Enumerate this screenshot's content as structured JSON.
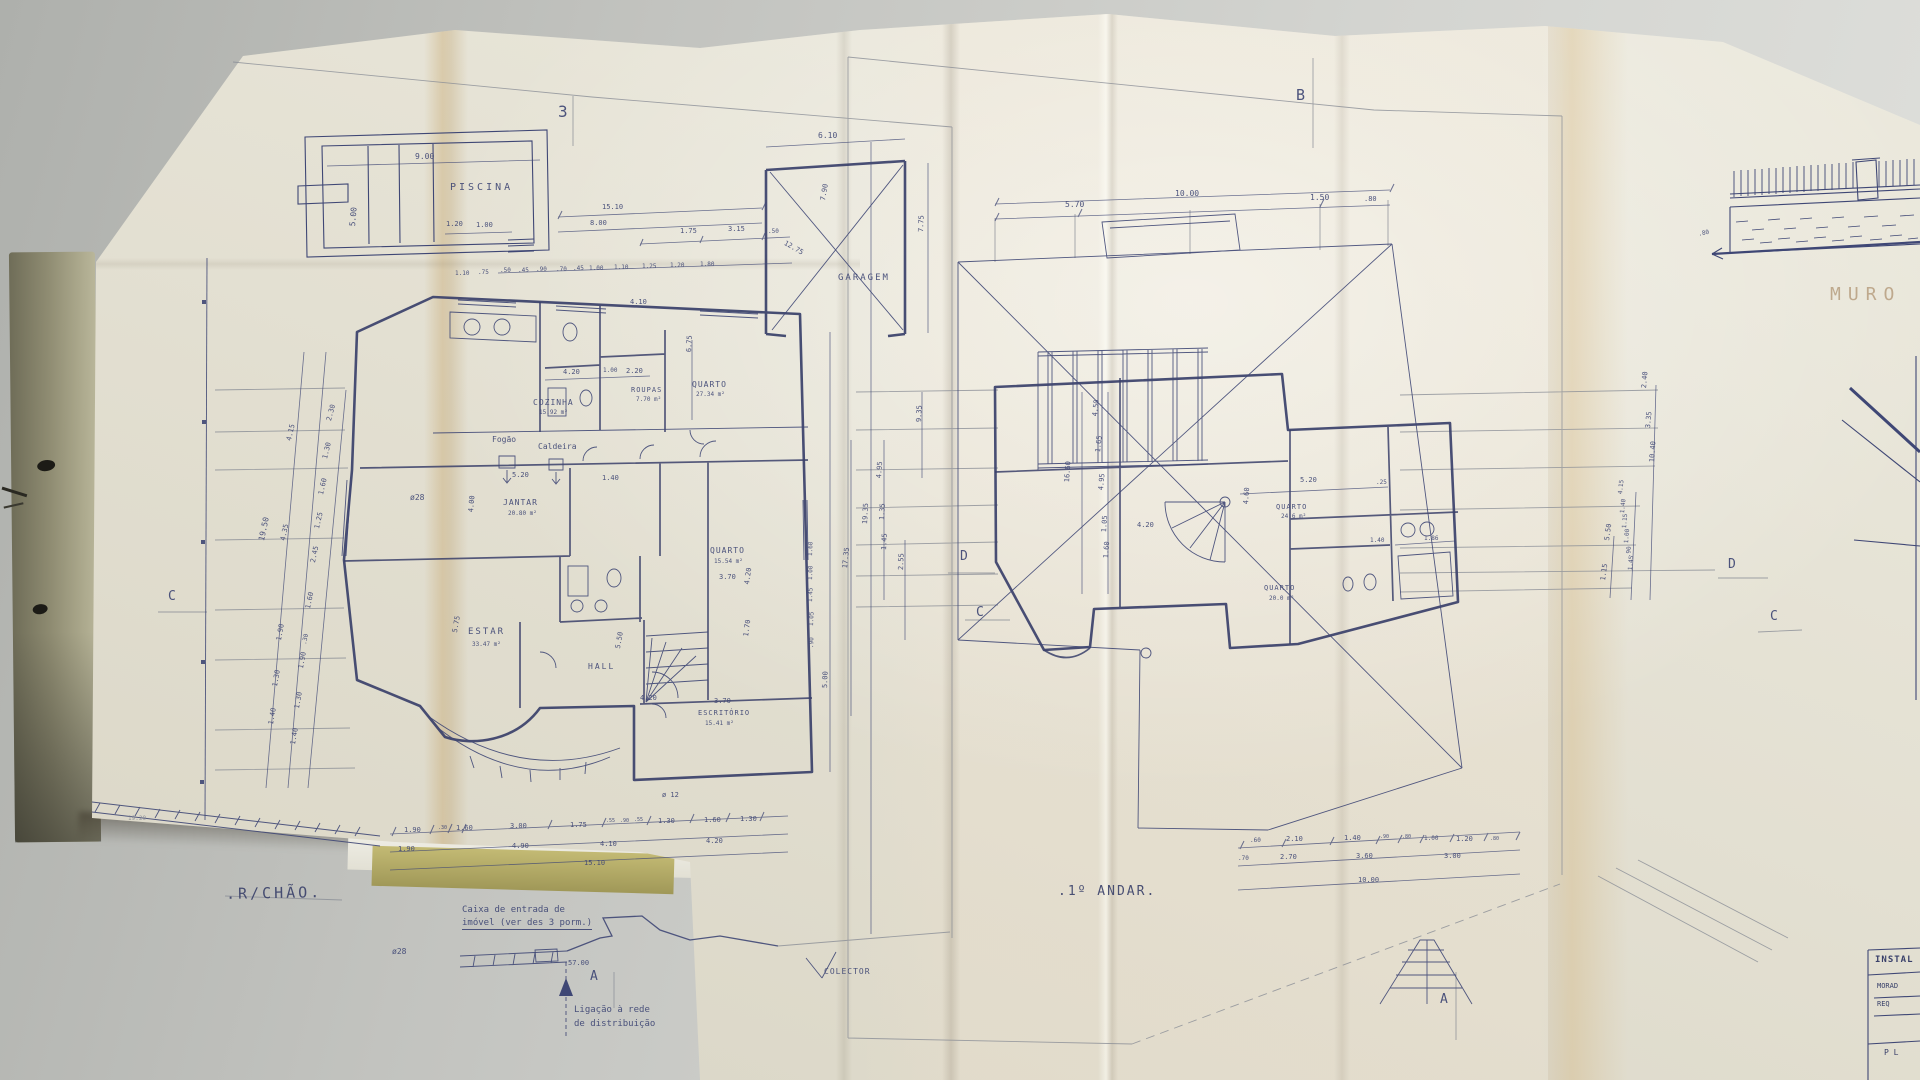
{
  "colors": {
    "ink": "#3f4775",
    "ink-dark": "#39406a",
    "pencil": "#8a8d96",
    "faded": "#b49a7a",
    "paper": "#e9e6d8",
    "fold": "#d6b684",
    "desk": "#c6c7c3"
  },
  "sheets": [
    {
      "title": ".R/CHÃO."
    },
    {
      "title": ".1º ANDAR."
    }
  ],
  "titleblock": {
    "header": "INSTAL",
    "row1": "MORAD",
    "row2": "REQ",
    "row3": "P L"
  },
  "annotations": [
    {
      "t": "PISCINA",
      "n": "label-piscina",
      "x": 450,
      "y": 183,
      "s": 10,
      "ls": 3
    },
    {
      "t": "9.00",
      "x": 415,
      "y": 153,
      "s": 8
    },
    {
      "t": "5.00",
      "x": 349,
      "y": 226,
      "s": 8,
      "r": -85
    },
    {
      "t": "1.20",
      "x": 446,
      "y": 221,
      "s": 7
    },
    {
      "t": "1.00",
      "x": 476,
      "y": 222,
      "s": 7
    },
    {
      "t": "3",
      "n": "marker-3",
      "x": 558,
      "y": 104,
      "s": 16
    },
    {
      "t": "15.10",
      "x": 602,
      "y": 204,
      "s": 7
    },
    {
      "t": "8.00",
      "x": 590,
      "y": 220,
      "s": 7
    },
    {
      "t": "1.75",
      "x": 680,
      "y": 228,
      "s": 7
    },
    {
      "t": "3.15",
      "x": 728,
      "y": 226,
      "s": 7
    },
    {
      "t": ".50",
      "x": 768,
      "y": 229,
      "s": 6
    },
    {
      "t": "1.10",
      "x": 455,
      "y": 271,
      "s": 6
    },
    {
      "t": ".75",
      "x": 478,
      "y": 270,
      "s": 6
    },
    {
      "t": ".50",
      "x": 500,
      "y": 268,
      "s": 6
    },
    {
      "t": ".45",
      "x": 518,
      "y": 268,
      "s": 6
    },
    {
      "t": ".90",
      "x": 536,
      "y": 267,
      "s": 6
    },
    {
      "t": ".70",
      "x": 556,
      "y": 267,
      "s": 6
    },
    {
      "t": ".45",
      "x": 573,
      "y": 266,
      "s": 6
    },
    {
      "t": "1.00",
      "x": 589,
      "y": 266,
      "s": 6
    },
    {
      "t": "1.10",
      "x": 614,
      "y": 265,
      "s": 6
    },
    {
      "t": "1.25",
      "x": 642,
      "y": 264,
      "s": 6
    },
    {
      "t": "1.20",
      "x": 670,
      "y": 263,
      "s": 6
    },
    {
      "t": "1.80",
      "x": 700,
      "y": 262,
      "s": 6
    },
    {
      "t": "6.10",
      "x": 818,
      "y": 132,
      "s": 8
    },
    {
      "t": "GARAGEM",
      "n": "label-garagem",
      "x": 838,
      "y": 274,
      "s": 9,
      "ls": 2
    },
    {
      "t": "7.75",
      "x": 918,
      "y": 232,
      "s": 7,
      "r": -88
    },
    {
      "t": "7.90",
      "x": 820,
      "y": 200,
      "s": 7,
      "r": -80
    },
    {
      "t": "12.75",
      "x": 786,
      "y": 240,
      "s": 7,
      "r": 30
    },
    {
      "t": "4.10",
      "x": 630,
      "y": 299,
      "s": 7
    },
    {
      "t": "4.20",
      "x": 563,
      "y": 369,
      "s": 7
    },
    {
      "t": "1.00",
      "x": 603,
      "y": 368,
      "s": 6
    },
    {
      "t": "2.20",
      "x": 626,
      "y": 368,
      "s": 7
    },
    {
      "t": "COZINHA",
      "n": "room-label-cozinha",
      "x": 533,
      "y": 399,
      "s": 8,
      "ls": 1
    },
    {
      "t": "15.92 m²",
      "x": 539,
      "y": 410,
      "s": 6
    },
    {
      "t": "ROUPAS",
      "n": "room-label-roupas",
      "x": 631,
      "y": 387,
      "s": 7,
      "ls": 1
    },
    {
      "t": "7.70 m²",
      "x": 636,
      "y": 397,
      "s": 6
    },
    {
      "t": "QUARTO",
      "n": "room-label-quarto-1",
      "x": 692,
      "y": 381,
      "s": 8,
      "ls": 1
    },
    {
      "t": "27.34 m²",
      "x": 696,
      "y": 392,
      "s": 6
    },
    {
      "t": "Fogão",
      "n": "note-fogao",
      "x": 492,
      "y": 436,
      "s": 8
    },
    {
      "t": "Caldeira",
      "n": "note-caldeira",
      "x": 538,
      "y": 443,
      "s": 8
    },
    {
      "t": "5.20",
      "x": 512,
      "y": 472,
      "s": 7
    },
    {
      "t": "1.40",
      "x": 602,
      "y": 475,
      "s": 7
    },
    {
      "t": "ø28",
      "n": "pipe-label",
      "x": 410,
      "y": 494,
      "s": 8
    },
    {
      "t": "JANTAR",
      "n": "room-label-jantar",
      "x": 503,
      "y": 499,
      "s": 8,
      "ls": 1
    },
    {
      "t": "20.80 m²",
      "x": 508,
      "y": 511,
      "s": 6
    },
    {
      "t": "4.00",
      "x": 468,
      "y": 512,
      "s": 7,
      "r": -85
    },
    {
      "t": "ESTAR",
      "n": "room-label-estar",
      "x": 468,
      "y": 628,
      "s": 9,
      "ls": 2
    },
    {
      "t": "33.47 m²",
      "x": 472,
      "y": 642,
      "s": 6
    },
    {
      "t": "5.75",
      "x": 452,
      "y": 632,
      "s": 7,
      "r": -80
    },
    {
      "t": "HALL",
      "n": "room-label-hall",
      "x": 588,
      "y": 663,
      "s": 8,
      "ls": 2
    },
    {
      "t": "5.50",
      "x": 615,
      "y": 648,
      "s": 7,
      "r": -80
    },
    {
      "t": "4.20",
      "x": 640,
      "y": 695,
      "s": 7
    },
    {
      "t": "QUARTO",
      "n": "room-label-quarto-2",
      "x": 710,
      "y": 547,
      "s": 8,
      "ls": 1
    },
    {
      "t": "15.54 m²",
      "x": 714,
      "y": 559,
      "s": 6
    },
    {
      "t": "3.70",
      "x": 719,
      "y": 574,
      "s": 7
    },
    {
      "t": "4.20",
      "x": 744,
      "y": 584,
      "s": 7,
      "r": -82
    },
    {
      "t": "1.70",
      "x": 743,
      "y": 636,
      "s": 7,
      "r": -82
    },
    {
      "t": "ESCRITÓRIO",
      "n": "room-label-escritorio",
      "x": 698,
      "y": 710,
      "s": 7,
      "ls": 1
    },
    {
      "t": "15.41 m²",
      "x": 705,
      "y": 721,
      "s": 6
    },
    {
      "t": "3.70",
      "x": 714,
      "y": 698,
      "s": 7
    },
    {
      "t": "6.75",
      "x": 686,
      "y": 352,
      "s": 7,
      "r": -87
    },
    {
      "t": "5.00",
      "x": 822,
      "y": 688,
      "s": 7,
      "r": -88
    },
    {
      "t": "17.35",
      "x": 842,
      "y": 568,
      "s": 7,
      "r": -84
    },
    {
      "t": "19.35",
      "x": 862,
      "y": 524,
      "s": 7,
      "r": -87
    },
    {
      "t": "1.60",
      "x": 808,
      "y": 556,
      "s": 6,
      "r": -88
    },
    {
      "t": "1.00",
      "x": 808,
      "y": 580,
      "s": 6,
      "r": -88
    },
    {
      "t": "1.45",
      "x": 808,
      "y": 602,
      "s": 6,
      "r": -88
    },
    {
      "t": "1.05",
      "x": 809,
      "y": 626,
      "s": 6,
      "r": -88
    },
    {
      "t": ".90",
      "x": 809,
      "y": 648,
      "s": 6,
      "r": -88
    },
    {
      "t": "2.55",
      "x": 898,
      "y": 570,
      "s": 7,
      "r": -88
    },
    {
      "t": "9.35",
      "x": 916,
      "y": 422,
      "s": 7,
      "r": -88
    },
    {
      "t": "19.50",
      "x": 258,
      "y": 540,
      "s": 8,
      "r": -78
    },
    {
      "t": "4.15",
      "x": 286,
      "y": 440,
      "s": 7,
      "r": -77
    },
    {
      "t": "4.35",
      "x": 280,
      "y": 540,
      "s": 7,
      "r": -78
    },
    {
      "t": "1.90",
      "x": 276,
      "y": 640,
      "s": 7,
      "r": -80
    },
    {
      "t": "1.30",
      "x": 272,
      "y": 686,
      "s": 7,
      "r": -80
    },
    {
      "t": "1.40",
      "x": 268,
      "y": 724,
      "s": 7,
      "r": -80
    },
    {
      "t": "2.30",
      "x": 326,
      "y": 420,
      "s": 7,
      "r": -75
    },
    {
      "t": "1.30",
      "x": 322,
      "y": 458,
      "s": 7,
      "r": -76
    },
    {
      "t": "1.60",
      "x": 318,
      "y": 494,
      "s": 7,
      "r": -77
    },
    {
      "t": "1.25",
      "x": 314,
      "y": 528,
      "s": 7,
      "r": -77
    },
    {
      "t": "2.45",
      "x": 310,
      "y": 562,
      "s": 7,
      "r": -78
    },
    {
      "t": "1.60",
      "x": 305,
      "y": 608,
      "s": 7,
      "r": -78
    },
    {
      "t": ".30",
      "x": 302,
      "y": 644,
      "s": 6,
      "r": -78
    },
    {
      "t": "1.90",
      "x": 298,
      "y": 668,
      "s": 7,
      "r": -80
    },
    {
      "t": "1.30",
      "x": 294,
      "y": 708,
      "s": 7,
      "r": -80
    },
    {
      "t": "1.40",
      "x": 290,
      "y": 744,
      "s": 7,
      "r": -80
    },
    {
      "t": "1.90",
      "x": 404,
      "y": 827,
      "s": 7
    },
    {
      "t": ".30",
      "x": 438,
      "y": 826,
      "s": 5
    },
    {
      "t": "1.60",
      "x": 456,
      "y": 825,
      "s": 7
    },
    {
      "t": "3.00",
      "x": 510,
      "y": 823,
      "s": 7
    },
    {
      "t": "1.75",
      "x": 570,
      "y": 822,
      "s": 7
    },
    {
      "t": ".55",
      "x": 606,
      "y": 819,
      "s": 5
    },
    {
      "t": ".90",
      "x": 620,
      "y": 819,
      "s": 5
    },
    {
      "t": ".55",
      "x": 634,
      "y": 818,
      "s": 5
    },
    {
      "t": "1.30",
      "x": 658,
      "y": 818,
      "s": 7
    },
    {
      "t": "1.60",
      "x": 704,
      "y": 817,
      "s": 7
    },
    {
      "t": "1.30",
      "x": 740,
      "y": 816,
      "s": 7
    },
    {
      "t": "1.90",
      "x": 398,
      "y": 846,
      "s": 7
    },
    {
      "t": "4.90",
      "x": 512,
      "y": 843,
      "s": 7
    },
    {
      "t": "4.10",
      "x": 600,
      "y": 841,
      "s": 7
    },
    {
      "t": "4.20",
      "x": 706,
      "y": 838,
      "s": 7
    },
    {
      "t": "15.10",
      "x": 584,
      "y": 860,
      "s": 7
    },
    {
      "t": "ø 12",
      "x": 662,
      "y": 792,
      "s": 7
    },
    {
      "t": "19.20",
      "x": 128,
      "y": 816,
      "s": 6,
      "c": "pencil"
    },
    {
      "t": "Caixa de entrada de",
      "n": "note-caixa",
      "x": 462,
      "y": 906,
      "s": 9
    },
    {
      "t": "imóvel (ver des 3 porm.)",
      "n": "note-caixa-2",
      "x": 462,
      "y": 919,
      "s": 9,
      "u": 1
    },
    {
      "t": "ø28",
      "n": "pipe-label",
      "x": 392,
      "y": 948,
      "s": 8
    },
    {
      "t": "57.00",
      "x": 568,
      "y": 960,
      "s": 7
    },
    {
      "t": "Ligação à rede",
      "n": "note-ligacao",
      "x": 574,
      "y": 1006,
      "s": 9
    },
    {
      "t": "de distribuição",
      "n": "note-ligacao-2",
      "x": 574,
      "y": 1020,
      "s": 9
    },
    {
      "t": "COLECTOR",
      "n": "label-colector",
      "x": 824,
      "y": 968,
      "s": 8,
      "ls": 1
    },
    {
      "t": "A",
      "n": "marker-a",
      "x": 590,
      "y": 970,
      "s": 13
    },
    {
      "t": "A",
      "n": "marker-a",
      "x": 1440,
      "y": 993,
      "s": 13
    },
    {
      "t": "B",
      "n": "marker-b",
      "x": 1296,
      "y": 88,
      "s": 15
    },
    {
      "t": "C",
      "n": "marker-c",
      "x": 168,
      "y": 590,
      "s": 13
    },
    {
      "t": "C",
      "n": "marker-c",
      "x": 976,
      "y": 606,
      "s": 13
    },
    {
      "t": "D",
      "n": "marker-d",
      "x": 960,
      "y": 550,
      "s": 13
    },
    {
      "t": "D",
      "n": "marker-d",
      "x": 1728,
      "y": 558,
      "s": 13
    },
    {
      "t": "C",
      "n": "marker-c",
      "x": 1770,
      "y": 610,
      "s": 13
    },
    {
      "t": "QUARTO",
      "n": "room-label-quarto-3",
      "x": 1276,
      "y": 504,
      "s": 7,
      "ls": 1
    },
    {
      "t": "24.6 m²",
      "x": 1281,
      "y": 514,
      "s": 6
    },
    {
      "t": "QUARTO",
      "n": "room-label-quarto-4",
      "x": 1264,
      "y": 585,
      "s": 7,
      "ls": 1
    },
    {
      "t": "20.0 m²",
      "x": 1269,
      "y": 596,
      "s": 6
    },
    {
      "t": "5.20",
      "x": 1300,
      "y": 477,
      "s": 7
    },
    {
      "t": ".25",
      "x": 1376,
      "y": 480,
      "s": 6
    },
    {
      "t": "4.60",
      "x": 1243,
      "y": 504,
      "s": 7,
      "r": -86
    },
    {
      "t": "1.40",
      "x": 1370,
      "y": 538,
      "s": 6
    },
    {
      "t": "1.86",
      "x": 1424,
      "y": 536,
      "s": 6
    },
    {
      "t": "4.20",
      "x": 1137,
      "y": 522,
      "s": 7
    },
    {
      "t": "10.00",
      "x": 1175,
      "y": 190,
      "s": 8
    },
    {
      "t": "5.70",
      "x": 1065,
      "y": 201,
      "s": 8
    },
    {
      "t": "1.50",
      "x": 1310,
      "y": 194,
      "s": 8
    },
    {
      "t": ".80",
      "x": 1364,
      "y": 196,
      "s": 7
    },
    {
      "t": "16.60",
      "x": 1064,
      "y": 482,
      "s": 7,
      "r": -86
    },
    {
      "t": "4.50",
      "x": 1092,
      "y": 416,
      "s": 7,
      "r": -84
    },
    {
      "t": "1.65",
      "x": 1095,
      "y": 452,
      "s": 7,
      "r": -84
    },
    {
      "t": "4.95",
      "x": 1098,
      "y": 490,
      "s": 7,
      "r": -85
    },
    {
      "t": "1.05",
      "x": 1101,
      "y": 532,
      "s": 7,
      "r": -86
    },
    {
      "t": "1.60",
      "x": 1103,
      "y": 558,
      "s": 7,
      "r": -86
    },
    {
      "t": "4.95",
      "x": 876,
      "y": 478,
      "s": 7,
      "r": -86
    },
    {
      "t": "1.35",
      "x": 879,
      "y": 520,
      "s": 7,
      "r": -87
    },
    {
      "t": "1.45",
      "x": 881,
      "y": 550,
      "s": 7,
      "r": -87
    },
    {
      "t": "2.40",
      "x": 1641,
      "y": 388,
      "s": 7,
      "r": -85
    },
    {
      "t": "3.35",
      "x": 1645,
      "y": 428,
      "s": 7,
      "r": -85
    },
    {
      "t": "10.40",
      "x": 1649,
      "y": 462,
      "s": 7,
      "r": -86
    },
    {
      "t": "4.15",
      "x": 1618,
      "y": 494,
      "s": 6,
      "r": -84
    },
    {
      "t": "1.40",
      "x": 1620,
      "y": 513,
      "s": 6,
      "r": -84
    },
    {
      "t": "1.15",
      "x": 1622,
      "y": 528,
      "s": 6,
      "r": -85
    },
    {
      "t": "1.00",
      "x": 1624,
      "y": 543,
      "s": 6,
      "r": -85
    },
    {
      "t": ".90",
      "x": 1626,
      "y": 557,
      "s": 6,
      "r": -85
    },
    {
      "t": "1.45",
      "x": 1628,
      "y": 570,
      "s": 6,
      "r": -85
    },
    {
      "t": "5.50",
      "x": 1604,
      "y": 540,
      "s": 7,
      "r": -82
    },
    {
      "t": "1.15",
      "x": 1600,
      "y": 580,
      "s": 7,
      "r": -82
    },
    {
      "t": ".60",
      "x": 1250,
      "y": 838,
      "s": 6
    },
    {
      "t": "2.10",
      "x": 1286,
      "y": 836,
      "s": 7
    },
    {
      "t": "1.40",
      "x": 1344,
      "y": 835,
      "s": 7
    },
    {
      "t": ".90",
      "x": 1380,
      "y": 835,
      "s": 5
    },
    {
      "t": ".80",
      "x": 1402,
      "y": 835,
      "s": 5
    },
    {
      "t": "1.00",
      "x": 1424,
      "y": 836,
      "s": 6
    },
    {
      "t": "1.20",
      "x": 1456,
      "y": 836,
      "s": 7
    },
    {
      "t": ".80",
      "x": 1490,
      "y": 837,
      "s": 5
    },
    {
      "t": ".70",
      "x": 1238,
      "y": 856,
      "s": 6
    },
    {
      "t": "2.70",
      "x": 1280,
      "y": 854,
      "s": 7
    },
    {
      "t": "3.60",
      "x": 1356,
      "y": 853,
      "s": 7
    },
    {
      "t": "3.00",
      "x": 1444,
      "y": 853,
      "s": 7
    },
    {
      "t": "10.00",
      "x": 1358,
      "y": 877,
      "s": 7
    },
    {
      "t": "MURO",
      "n": "label-muro",
      "x": 1830,
      "y": 286,
      "s": 18,
      "ls": 7,
      "c": "faded"
    },
    {
      "t": ".80",
      "x": 1698,
      "y": 232,
      "s": 6,
      "r": -12
    }
  ]
}
